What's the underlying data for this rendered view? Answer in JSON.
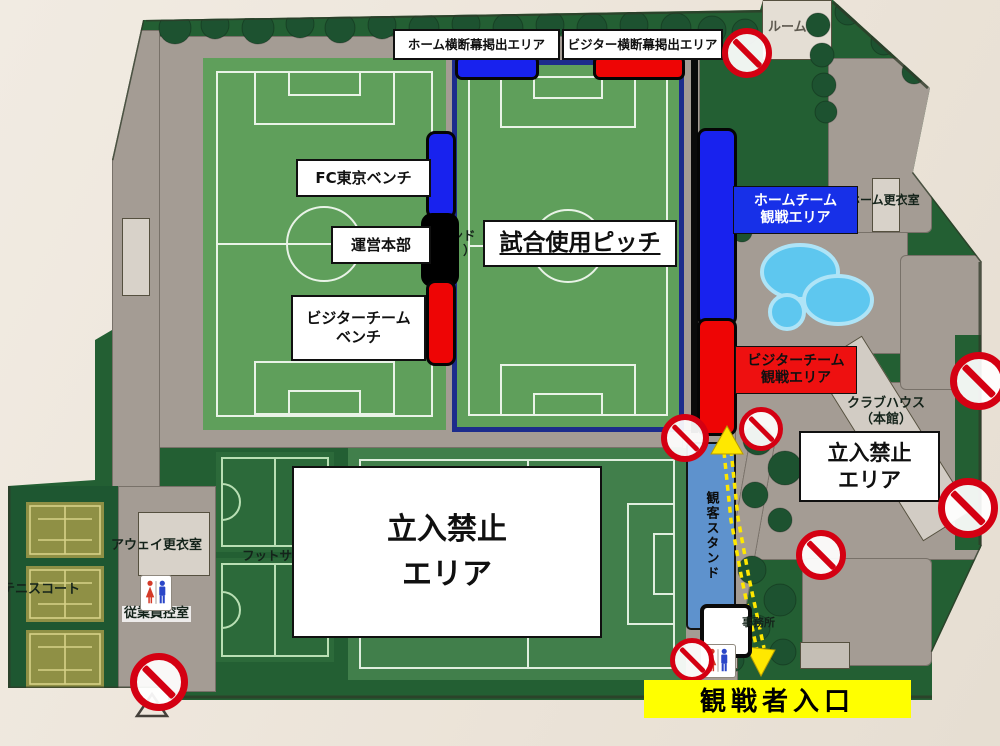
{
  "labels": {
    "home_banner": "ホーム横断幕掲出エリア",
    "visitor_banner": "ビジター横断幕掲出エリア",
    "fc_tokyo_bench": "FC東京ベンチ",
    "operations_hq": "運営本部",
    "visitor_team_bench": "ビジターチーム\nベンチ",
    "match_pitch": "試合使用ピッチ",
    "home_team_spectator_area": "ホームチーム\n観戦エリア",
    "visitor_team_spectator_area": "ビジターチーム\n観戦エリア",
    "no_entry_area_center": "立入禁止\nエリア",
    "no_entry_area_right": "立入禁止\nエリア",
    "spectator_entrance": "観戦者入口"
  },
  "map_texts": {
    "room": "ルーム",
    "home_locker_room": "ホーム更衣室",
    "clubhouse": "クラブハウス\n（本館）",
    "away_locker_room": "アウェイ更衣室",
    "tennis_court": "テニスコート",
    "staff_room": "従業員控室",
    "futsal": "フットサル",
    "spectator_stand": "観客スタンド",
    "office": "事務所",
    "ground_name_fragment": "ランド\n（　）"
  },
  "colors": {
    "home_blue": "#1822ee",
    "visitor_red": "#ee0505",
    "entrance_yellow": "#ffff00",
    "no_entry_red": "#d40012",
    "pitch_green": "#5f9f5b",
    "dark_green": "#235f33",
    "path_gray": "#a49c94",
    "pool_blue": "#5ec7ef",
    "stand_blue": "#5e92cd",
    "match_pitch_border_navy": "#1c2c8c",
    "photo_background": "#ece4da"
  },
  "icons": {
    "no_entry": "red-circle-with-diagonal-slash",
    "restroom": "female-male-figures",
    "route": "yellow-double-dashed-arrow"
  }
}
